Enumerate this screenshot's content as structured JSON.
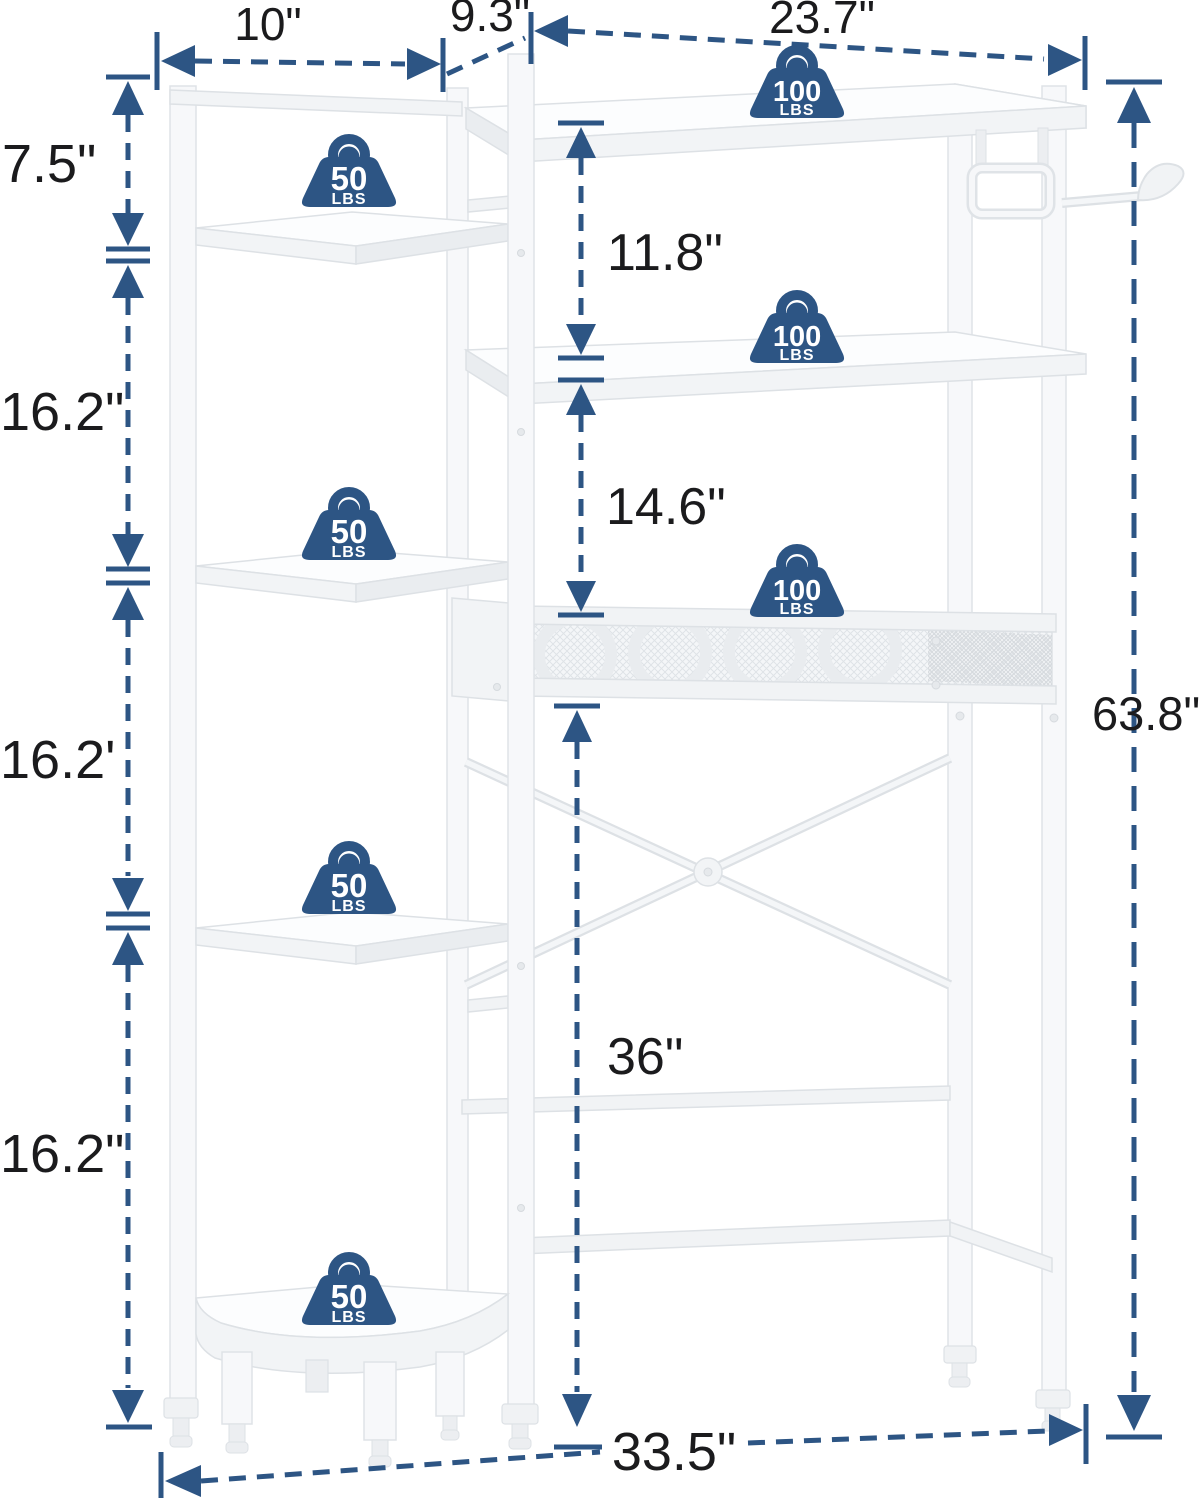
{
  "image": {
    "width_px": 1203,
    "height_px": 1500,
    "background": "#ffffff"
  },
  "colors": {
    "dimension_accent": "#2d5584",
    "label_text": "#1b1b1d",
    "badge_fill": "#2d5584",
    "badge_text": "#ffffff",
    "furniture_white": "#f7f8fa",
    "furniture_edge": "#dde1e5"
  },
  "dimensions": {
    "left_tower_width": "10\"",
    "rack_depth": "9.3\"",
    "top_shelf_width": "23.7\"",
    "tower_top_gap": "7.5\"",
    "tower_shelf_gap_1": "16.2\"",
    "tower_shelf_gap_2": "16.2'",
    "tower_shelf_gap_3": "16.2\"",
    "top_to_second_shelf": "11.8\"",
    "second_shelf_to_basket": "14.6\"",
    "clearance_height": "36\"",
    "total_height": "63.8\"",
    "total_width": "33.5\""
  },
  "capacity_badges": {
    "tower_shelf": {
      "value": "50",
      "unit": "LBS",
      "count": 4
    },
    "rack_shelf": {
      "value": "100",
      "unit": "LBS",
      "count": 3
    }
  }
}
